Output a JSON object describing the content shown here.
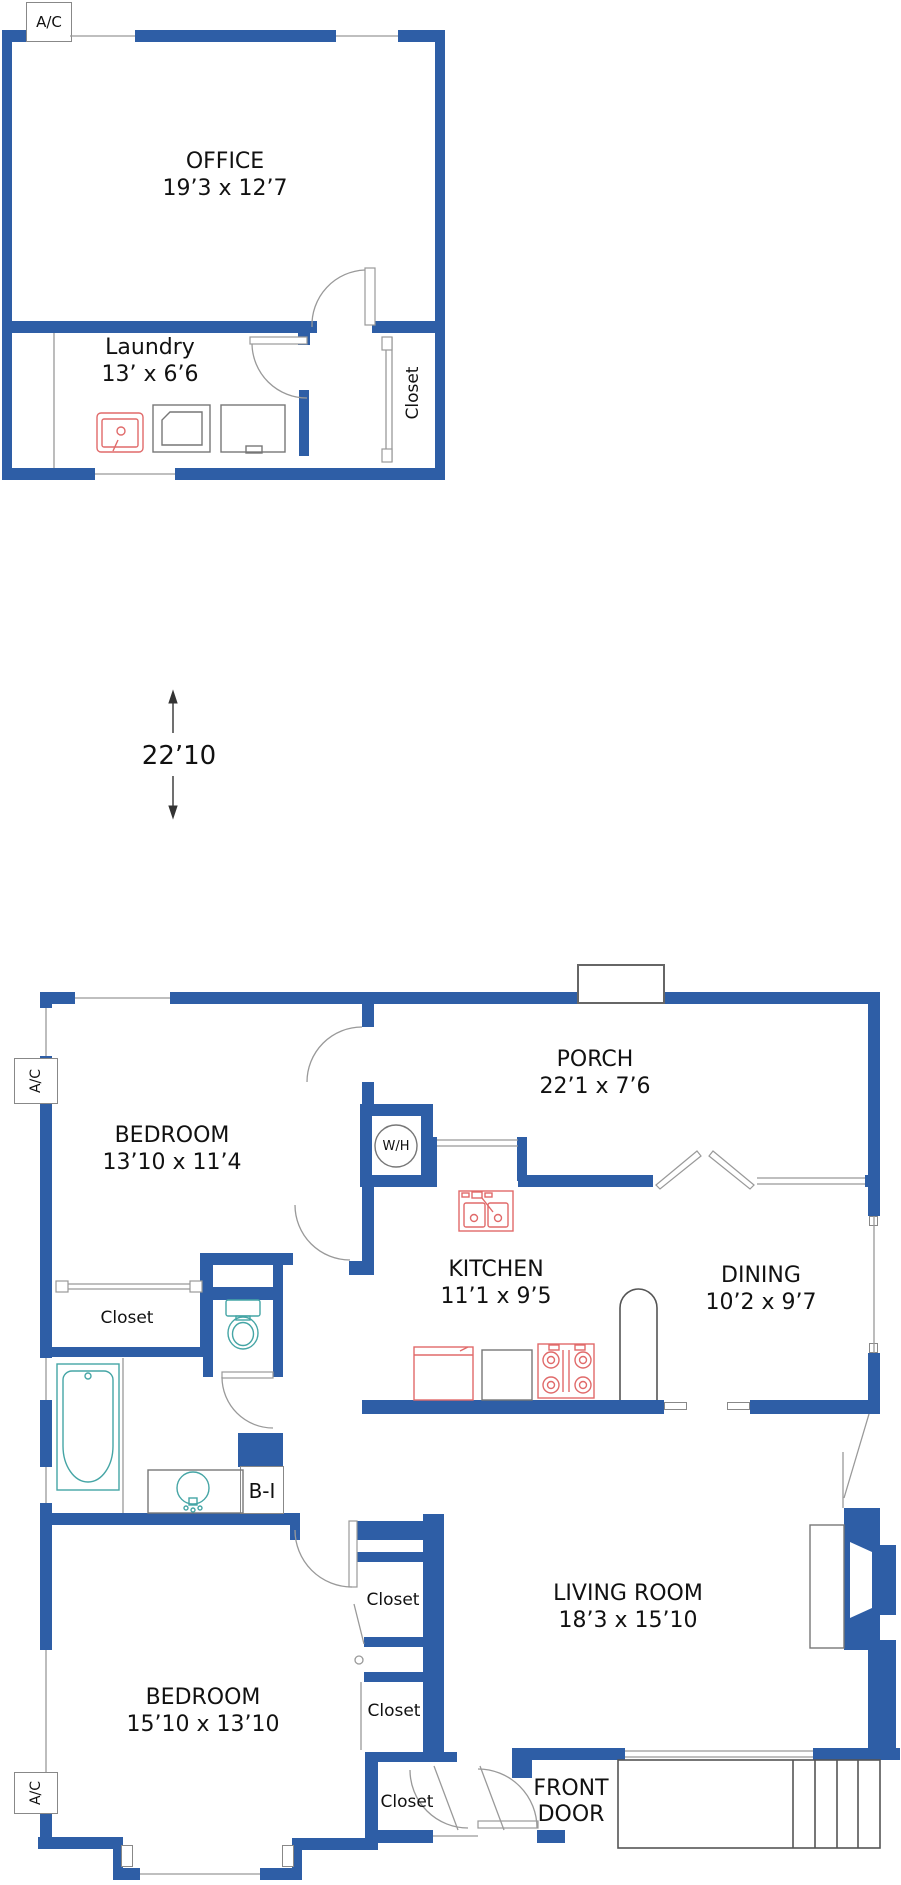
{
  "palette": {
    "wall_blue": "#2e5ea6",
    "fixture_red": "#e06a6a",
    "fixture_teal": "#45a5a5",
    "door_gray": "#999999",
    "outline_gray": "#777777",
    "text_black": "#111111"
  },
  "upper_building": {
    "ac_label": "A/C",
    "office": {
      "name": "OFFICE",
      "dims": "19’3 x 12’7"
    },
    "laundry": {
      "name": "Laundry",
      "dims": "13’ x 6’6"
    },
    "closet_label": "Closet"
  },
  "site_dimension": {
    "label": "22’10"
  },
  "main_building": {
    "ac_upper_label": "A/C",
    "ac_lower_label": "A/C",
    "bedroom_top": {
      "name": "BEDROOM",
      "dims": "13’10 x 11’4"
    },
    "porch": {
      "name": "PORCH",
      "dims": "22’1 x 7’6"
    },
    "water_heater_label": "W/H",
    "kitchen": {
      "name": "KITCHEN",
      "dims": "11’1 x 9’5"
    },
    "dining": {
      "name": "DINING",
      "dims": "10’2 x 9’7"
    },
    "bathroom_closet_label": "Closet",
    "built_in_label": "B-I",
    "living_room": {
      "name": "LIVING ROOM",
      "dims": "18’3 x 15’10"
    },
    "closet_upper_label": "Closet",
    "closet_middle_label": "Closet",
    "closet_front_label": "Closet",
    "bedroom_bottom": {
      "name": "BEDROOM",
      "dims": "15’10 x 13’10"
    },
    "front_door_label": "FRONT DOOR"
  }
}
